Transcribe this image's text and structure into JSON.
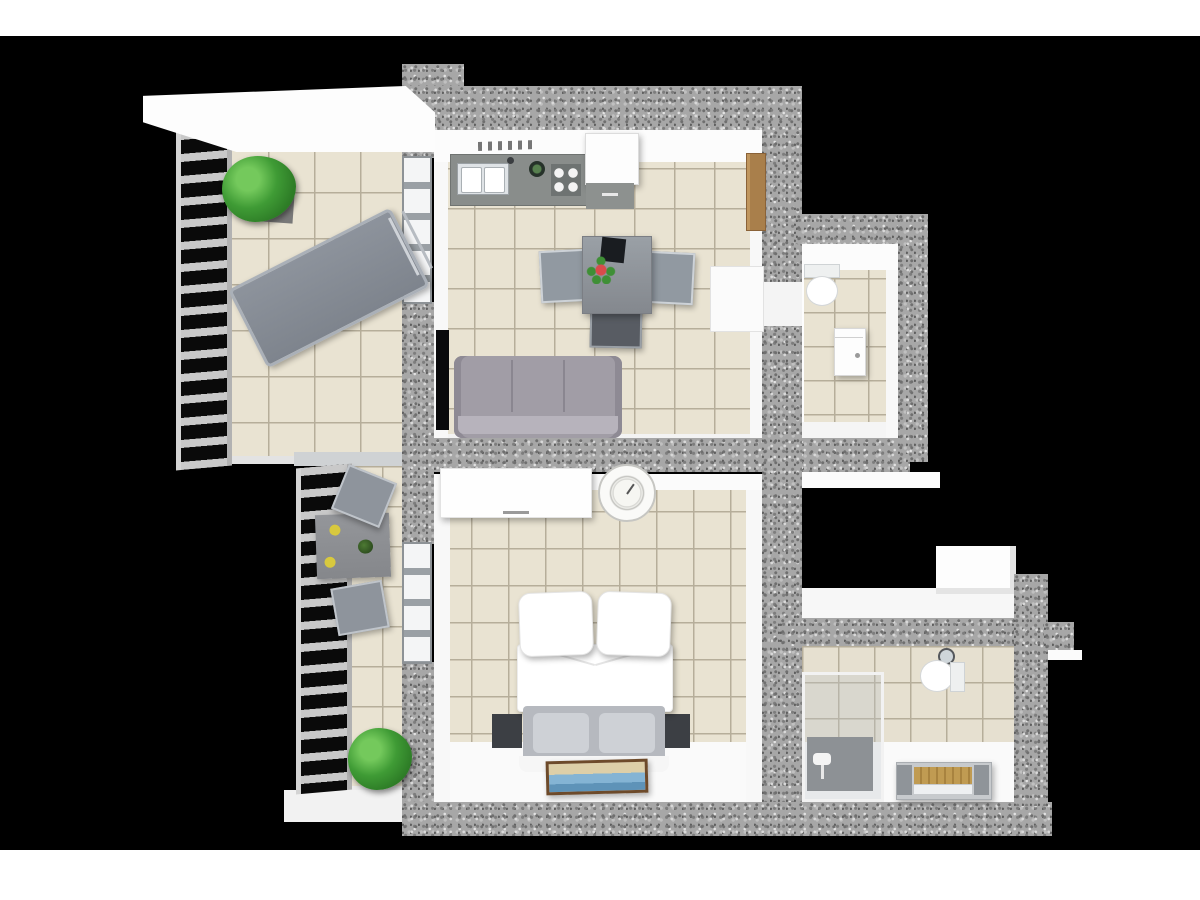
{
  "scene": {
    "title": "3D rendered apartment floor plan, top-down cutaway view",
    "background": "#000000",
    "letterbox_color": "#ffffff",
    "style": "architectural 3D floor plan render, granite cut walls, beige tiled floors"
  },
  "palette": {
    "wall_granite": "#a7a7a7",
    "wall_inner_face": "#fbfbfb",
    "tile_floor": "#e9e3d2",
    "tile_grout": "#b6ae9a",
    "furniture_gray": "#9097a0",
    "sofa_gray": "#a19da6",
    "wood_door": "#a97f4b",
    "bathtub_wood": "#c09b52",
    "plant_green": "#3f9b35",
    "flower_red": "#d94b4b",
    "plate_yellow": "#d8c93e",
    "tv_black": "#0a0a0c",
    "bed_linen": "#ffffff",
    "shower_tray": "#8d9195",
    "railing_slat": "#c9c9c9"
  },
  "rooms": [
    {
      "id": "balcony-upper",
      "label": "Large balcony with sun lounger, plant, canopy and railing",
      "furniture": [
        "canopy",
        "safety railing",
        "potted plant",
        "sun lounger"
      ]
    },
    {
      "id": "living-kitchen",
      "label": "Living room with open kitchen and dining area",
      "furniture": [
        "kitchen counter with double sink, pot and 4-burner hob",
        "fridge with base cabinet",
        "spice shelf",
        "open wooden door",
        "dining table",
        "tablet on table",
        "flower centerpiece",
        "three dining chairs",
        "gray sofa",
        "wall-mounted TV"
      ]
    },
    {
      "id": "wc",
      "label": "Guest WC with toilet and vanity cabinet",
      "furniture": [
        "toilet with cistern",
        "vanity cabinet"
      ]
    },
    {
      "id": "balcony-lower",
      "label": "Narrow balcony with bistro table, two chairs and plant",
      "furniture": [
        "railing",
        "bistro table with two yellow plates and small plant",
        "two gray chairs",
        "potted plant"
      ]
    },
    {
      "id": "bedroom",
      "label": "Bedroom with double bed, wardrobe, clock and picture",
      "furniture": [
        "white wardrobe",
        "round wall clock",
        "double bed with two pillows and duvet",
        "two dark nightstands",
        "framed seascape picture"
      ]
    },
    {
      "id": "bathroom",
      "label": "Bathroom with glass shower, toilet and bathtub",
      "furniture": [
        "glass shower cabin with gray tray",
        "round mirror",
        "toilet with cistern",
        "bathtub with wooden panel"
      ]
    },
    {
      "id": "roof-terrace",
      "label": "Small open terrace with white parapet above the bathroom",
      "furniture": []
    }
  ]
}
